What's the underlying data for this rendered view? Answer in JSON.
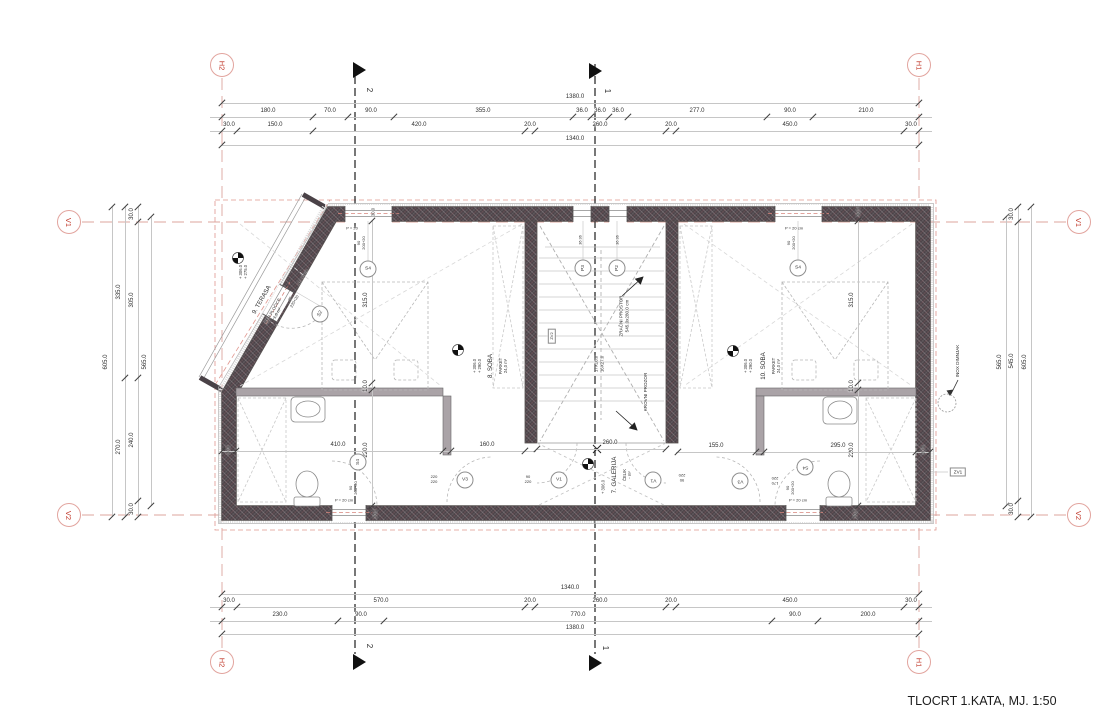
{
  "title": "TLOCRT 1.KATA, MJ. 1:50",
  "colors": {
    "grid_marker_text": "#c0392b",
    "grid_marker_ring": "#e2a49e",
    "grid_line_red": "#dca49e",
    "wall_fill": "#4a4247",
    "dim_line_gray": "#c6c6c6",
    "dim_text": "#2f2f2f"
  },
  "grid_markers": [
    {
      "id": "H2",
      "x": 222,
      "y": 65
    },
    {
      "id": "H1",
      "x": 919,
      "y": 65
    },
    {
      "id": "H2",
      "x": 222,
      "y": 662
    },
    {
      "id": "H1",
      "x": 919,
      "y": 662
    },
    {
      "id": "V1",
      "x": 69,
      "y": 222
    },
    {
      "id": "V2",
      "x": 69,
      "y": 515
    },
    {
      "id": "V1",
      "x": 1079,
      "y": 222
    },
    {
      "id": "V2",
      "x": 1079,
      "y": 515
    }
  ],
  "dim_chains": [
    {
      "name": "top-total-outer",
      "o": "h",
      "pos": 103,
      "from": 222,
      "to": 919,
      "ticks": [
        222,
        919
      ],
      "labels": [
        {
          "t": "1380.0",
          "c": 575
        }
      ]
    },
    {
      "name": "top-detail-1",
      "o": "h",
      "pos": 117,
      "from": 210,
      "to": 932,
      "ticks": [
        222,
        313,
        348,
        394,
        573,
        591,
        609,
        628,
        767,
        813,
        919
      ],
      "labels": [
        {
          "t": "180.0",
          "c": 268
        },
        {
          "t": "70.0",
          "c": 330
        },
        {
          "t": "90.0",
          "c": 371
        },
        {
          "t": "355.0",
          "c": 483
        },
        {
          "t": "36.0",
          "c": 582
        },
        {
          "t": "36.0",
          "c": 600
        },
        {
          "t": "36.0",
          "c": 618
        },
        {
          "t": "277.0",
          "c": 697
        },
        {
          "t": "90.0",
          "c": 790
        },
        {
          "t": "210.0",
          "c": 866
        }
      ]
    },
    {
      "name": "top-detail-2",
      "o": "h",
      "pos": 131,
      "from": 210,
      "to": 932,
      "ticks": [
        222,
        237,
        313,
        525,
        535,
        666,
        676,
        904,
        919
      ],
      "labels": [
        {
          "t": "30.0",
          "c": 229
        },
        {
          "t": "150.0",
          "c": 275
        },
        {
          "t": "420.0",
          "c": 419
        },
        {
          "t": "20.0",
          "c": 530
        },
        {
          "t": "260.0",
          "c": 600
        },
        {
          "t": "20.0",
          "c": 671
        },
        {
          "t": "450.0",
          "c": 790
        },
        {
          "t": "30.0",
          "c": 911
        }
      ]
    },
    {
      "name": "top-total-inner",
      "o": "h",
      "pos": 145,
      "from": 222,
      "to": 919,
      "ticks": [
        222,
        919
      ],
      "labels": [
        {
          "t": "1340.0",
          "c": 575
        }
      ]
    },
    {
      "name": "bottom-total-inner",
      "o": "h",
      "pos": 594,
      "from": 222,
      "to": 919,
      "ticks": [
        222,
        919
      ],
      "labels": [
        {
          "t": "1340.0",
          "c": 570
        }
      ]
    },
    {
      "name": "bottom-detail-1",
      "o": "h",
      "pos": 607,
      "from": 210,
      "to": 932,
      "ticks": [
        222,
        237,
        525,
        535,
        666,
        676,
        904,
        919
      ],
      "labels": [
        {
          "t": "30.0",
          "c": 229
        },
        {
          "t": "570.0",
          "c": 381
        },
        {
          "t": "20.0",
          "c": 530
        },
        {
          "t": "260.0",
          "c": 600
        },
        {
          "t": "20.0",
          "c": 671
        },
        {
          "t": "450.0",
          "c": 790
        },
        {
          "t": "30.0",
          "c": 911
        }
      ]
    },
    {
      "name": "bottom-detail-2",
      "o": "h",
      "pos": 621,
      "from": 210,
      "to": 932,
      "ticks": [
        222,
        338,
        384,
        772,
        818,
        919
      ],
      "labels": [
        {
          "t": "230.0",
          "c": 280
        },
        {
          "t": "90.0",
          "c": 361
        },
        {
          "t": "770.0",
          "c": 578
        },
        {
          "t": "90.0",
          "c": 795
        },
        {
          "t": "200.0",
          "c": 868
        }
      ]
    },
    {
      "name": "bottom-total-outer",
      "o": "h",
      "pos": 634,
      "from": 222,
      "to": 919,
      "ticks": [
        222,
        919
      ],
      "labels": [
        {
          "t": "1380.0",
          "c": 575
        }
      ]
    },
    {
      "name": "left-total",
      "o": "v",
      "pos": 112,
      "from": 207,
      "to": 517,
      "ticks": [
        207,
        517
      ],
      "labels": [
        {
          "t": "605.0",
          "c": 362
        }
      ]
    },
    {
      "name": "left-mid",
      "o": "v",
      "pos": 125,
      "from": 207,
      "to": 517,
      "ticks": [
        207,
        378,
        517
      ],
      "labels": [
        {
          "t": "335.0",
          "c": 292
        },
        {
          "t": "270.0",
          "c": 447
        }
      ]
    },
    {
      "name": "left-detail",
      "o": "v",
      "pos": 138,
      "from": 207,
      "to": 517,
      "ticks": [
        207,
        222,
        378,
        501,
        517
      ],
      "labels": [
        {
          "t": "30.0",
          "c": 214
        },
        {
          "t": "305.0",
          "c": 300
        },
        {
          "t": "240.0",
          "c": 440
        },
        {
          "t": "30.0",
          "c": 509
        }
      ]
    },
    {
      "name": "left-inner",
      "o": "v",
      "pos": 151,
      "from": 217,
      "to": 506,
      "ticks": [
        217,
        506
      ],
      "labels": [
        {
          "t": "565.0",
          "c": 362
        }
      ]
    },
    {
      "name": "right-inner",
      "o": "v",
      "pos": 1006,
      "from": 217,
      "to": 506,
      "ticks": [
        217,
        506
      ],
      "labels": [
        {
          "t": "565.0",
          "c": 362
        }
      ]
    },
    {
      "name": "right-detail",
      "o": "v",
      "pos": 1018,
      "from": 207,
      "to": 517,
      "ticks": [
        207,
        222,
        501,
        517
      ],
      "labels": [
        {
          "t": "30.0",
          "c": 214
        },
        {
          "t": "545.0",
          "c": 361
        },
        {
          "t": "30.0",
          "c": 509
        }
      ]
    },
    {
      "name": "right-total",
      "o": "v",
      "pos": 1031,
      "from": 207,
      "to": 517,
      "ticks": [
        207,
        517
      ],
      "labels": [
        {
          "t": "605.0",
          "c": 362
        }
      ]
    },
    {
      "name": "room8-vertical",
      "o": "v",
      "pos": 372,
      "from": 221,
      "to": 506,
      "ticks": [
        221,
        383,
        390,
        506
      ],
      "labels": [
        {
          "t": "315.0",
          "c": 300
        },
        {
          "t": "10.0",
          "c": 386
        },
        {
          "t": "220.0",
          "c": 450
        }
      ]
    },
    {
      "name": "room10-vertical",
      "o": "v",
      "pos": 858,
      "from": 221,
      "to": 506,
      "ticks": [
        221,
        383,
        390,
        506
      ],
      "labels": [
        {
          "t": "315.0",
          "c": 300
        },
        {
          "t": "10.0",
          "c": 386
        },
        {
          "t": "220.0",
          "c": 450
        }
      ]
    },
    {
      "name": "bath-left",
      "o": "h",
      "pos": 451,
      "from": 222,
      "to": 536,
      "ticks": [
        222,
        236,
        443,
        451,
        525
      ],
      "labels": [
        {
          "t": "410.0",
          "c": 338
        },
        {
          "t": "160.0",
          "c": 487
        }
      ]
    },
    {
      "name": "bath-right",
      "o": "h",
      "pos": 452,
      "from": 676,
      "to": 930,
      "ticks": [
        678,
        756,
        764,
        916,
        930
      ],
      "labels": [
        {
          "t": "155.0",
          "c": 716
        },
        {
          "t": "295.0",
          "c": 838
        }
      ]
    },
    {
      "name": "gallery-width",
      "o": "h",
      "pos": 449,
      "from": 537,
      "to": 666,
      "ticks": [
        537,
        666
      ],
      "labels": [
        {
          "t": "260.0",
          "c": 610
        }
      ]
    }
  ],
  "annotations": [
    {
      "n": "section-2-top",
      "t": "2",
      "x": 369,
      "y": 90,
      "r": 90,
      "s": 8
    },
    {
      "n": "section-1-top",
      "t": "1",
      "x": 607,
      "y": 91,
      "r": 90,
      "s": 8
    },
    {
      "n": "section-2-bottom",
      "t": "2",
      "x": 369,
      "y": 646,
      "r": 90,
      "s": 8
    },
    {
      "n": "section-1-bottom",
      "t": "1",
      "x": 605,
      "y": 648,
      "r": 90,
      "s": 8
    },
    {
      "n": "terrace-name",
      "t": "9. TERASA",
      "x": 262,
      "y": 300,
      "r": -60,
      "s": 6.2
    },
    {
      "n": "terrace-sub",
      "t": "KER.PLOČICE\n1,6 m²",
      "x": 275,
      "y": 312,
      "r": -60,
      "s": 4.2
    },
    {
      "n": "terrace-elev",
      "t": "+ 306.0\n+ 275.0",
      "x": 243,
      "y": 272,
      "r": -90,
      "s": 4.2
    },
    {
      "n": "terrace-door-parapet",
      "t": "P = 0 cm",
      "x": 303,
      "y": 277,
      "r": -60,
      "s": 4
    },
    {
      "n": "terrace-door-size",
      "t": "90\n220+20",
      "x": 292,
      "y": 300,
      "r": -60,
      "s": 4
    },
    {
      "n": "win-tl-parapet",
      "t": "P = 20",
      "x": 352,
      "y": 228,
      "r": 0,
      "s": 4
    },
    {
      "n": "win-tl-size",
      "t": "90\n200+20",
      "x": 361,
      "y": 243,
      "r": -90,
      "s": 4
    },
    {
      "n": "win-tr-parapet",
      "t": "P = 20 cm",
      "x": 794,
      "y": 228,
      "r": 0,
      "s": 4
    },
    {
      "n": "win-tr-size",
      "t": "90\n200+20",
      "x": 791,
      "y": 243,
      "r": -90,
      "s": 4
    },
    {
      "n": "win-bl-parapet",
      "t": "P = 20 cm",
      "x": 344,
      "y": 500,
      "r": 0,
      "s": 4
    },
    {
      "n": "win-bl-size",
      "t": "90\n200+20",
      "x": 353,
      "y": 488,
      "r": -90,
      "s": 4
    },
    {
      "n": "win-br-parapet",
      "t": "P = 20 cm",
      "x": 798,
      "y": 500,
      "r": 0,
      "s": 4
    },
    {
      "n": "win-br-size",
      "t": "90\n200+20",
      "x": 790,
      "y": 488,
      "r": -90,
      "s": 4
    },
    {
      "n": "wall-dim-top-left",
      "t": "30.0",
      "x": 373,
      "y": 212,
      "r": -90,
      "s": 4.2
    },
    {
      "n": "wall-dim-top-right",
      "t": "30.0",
      "x": 858,
      "y": 212,
      "r": -90,
      "s": 4.2
    },
    {
      "n": "wall-dim-bottom-left",
      "t": "30.0",
      "x": 375,
      "y": 514,
      "r": -90,
      "s": 4.2
    },
    {
      "n": "wall-dim-bottom-right",
      "t": "30.0",
      "x": 855,
      "y": 514,
      "r": -90,
      "s": 4.2
    },
    {
      "n": "wall-dim-bath-left",
      "t": "30.0",
      "x": 228,
      "y": 450,
      "r": -90,
      "s": 4.2
    },
    {
      "n": "wall-dim-bath-right",
      "t": "30.0",
      "x": 923,
      "y": 450,
      "r": -90,
      "s": 4.2
    },
    {
      "n": "roofwin-dim-left",
      "t": "36  36",
      "x": 581,
      "y": 240,
      "r": -90,
      "s": 3.8
    },
    {
      "n": "roofwin-dim-right",
      "t": "36  36",
      "x": 618,
      "y": 240,
      "r": -90,
      "s": 3.8
    },
    {
      "n": "void-label",
      "t": "ZRAČNI PROSTOR\n545.0x280.0 cm",
      "x": 624,
      "y": 316,
      "r": -90,
      "s": 4.6
    },
    {
      "n": "roof-window-label",
      "t": "KROVNI PROZOR",
      "x": 646,
      "y": 392,
      "r": -90,
      "s": 4.6
    },
    {
      "n": "stair-dims",
      "t": "17X16.0\n16X27.0",
      "x": 599,
      "y": 364,
      "r": -90,
      "s": 4.4
    },
    {
      "n": "room8-name",
      "t": "8. SOBA",
      "x": 491,
      "y": 366,
      "r": -90,
      "s": 6.2
    },
    {
      "n": "room8-sub",
      "t": "PARKET\n24,0 m²",
      "x": 503,
      "y": 366,
      "r": -90,
      "s": 4.2
    },
    {
      "n": "room8-elev",
      "t": "+ 306.0\n+ 290.0",
      "x": 477,
      "y": 366,
      "r": -90,
      "s": 4.2
    },
    {
      "n": "room10-name",
      "t": "10. SOBA",
      "x": 764,
      "y": 366,
      "r": -90,
      "s": 6.2
    },
    {
      "n": "room10-sub",
      "t": "PARKET\n24,0 m²",
      "x": 776,
      "y": 366,
      "r": -90,
      "s": 4.2
    },
    {
      "n": "room10-elev",
      "t": "+ 306.0\n+ 290.0",
      "x": 748,
      "y": 366,
      "r": -90,
      "s": 4.2
    },
    {
      "n": "gallery-name",
      "t": "7. GALERIJA",
      "x": 615,
      "y": 475,
      "r": -90,
      "s": 6.2
    },
    {
      "n": "gallery-sub",
      "t": "ČELIK\n- m²",
      "x": 627,
      "y": 475,
      "r": -90,
      "s": 4.2
    },
    {
      "n": "gallery-elev",
      "t": "+ 306.0",
      "x": 603,
      "y": 487,
      "r": -90,
      "s": 4.2
    },
    {
      "n": "chimney-label",
      "t": "INOX DIMNJAK",
      "x": 958,
      "y": 361,
      "r": -90,
      "s": 4.6
    },
    {
      "n": "zv1-label",
      "t": "ZV1",
      "x": 958,
      "y": 472,
      "r": 0,
      "s": 4.6,
      "box": true
    },
    {
      "n": "zv2-label",
      "t": "ZV2",
      "x": 552,
      "y": 336,
      "r": -90,
      "s": 4,
      "box": true
    },
    {
      "n": "door-frac-gallery-left",
      "t": "90\n220",
      "x": 528,
      "y": 479,
      "r": 0,
      "s": 4
    },
    {
      "n": "door-frac-gallery-right",
      "t": "90\n220",
      "x": 682,
      "y": 478,
      "r": 180,
      "s": 4
    },
    {
      "n": "door-frac-bath-left",
      "t": "220\n220",
      "x": 434,
      "y": 479,
      "r": 0,
      "s": 4
    },
    {
      "n": "door-frac-bath-right",
      "t": "170\n220",
      "x": 775,
      "y": 481,
      "r": 180,
      "s": 4
    },
    {
      "n": "gallery-dim-extra",
      "t": "260.0",
      "x": 612,
      "y": 451,
      "r": 0,
      "s": 0.1
    }
  ],
  "circles": [
    {
      "t": "S4",
      "x": 368,
      "y": 269,
      "r": 0
    },
    {
      "t": "S2",
      "x": 320,
      "y": 314,
      "r": -60
    },
    {
      "t": "S4",
      "x": 798,
      "y": 268,
      "r": 0
    },
    {
      "t": "P3",
      "x": 583,
      "y": 268,
      "r": -90
    },
    {
      "t": "P2",
      "x": 617,
      "y": 268,
      "r": -90
    },
    {
      "t": "V1",
      "x": 559,
      "y": 480,
      "r": 0
    },
    {
      "t": "V1",
      "x": 653,
      "y": 480,
      "r": 180
    },
    {
      "t": "V3",
      "x": 465,
      "y": 480,
      "r": 0
    },
    {
      "t": "V3",
      "x": 740,
      "y": 481,
      "r": 180
    },
    {
      "t": "S4",
      "x": 358,
      "y": 462,
      "r": -90
    },
    {
      "t": "S4",
      "x": 805,
      "y": 467,
      "r": 180
    }
  ]
}
